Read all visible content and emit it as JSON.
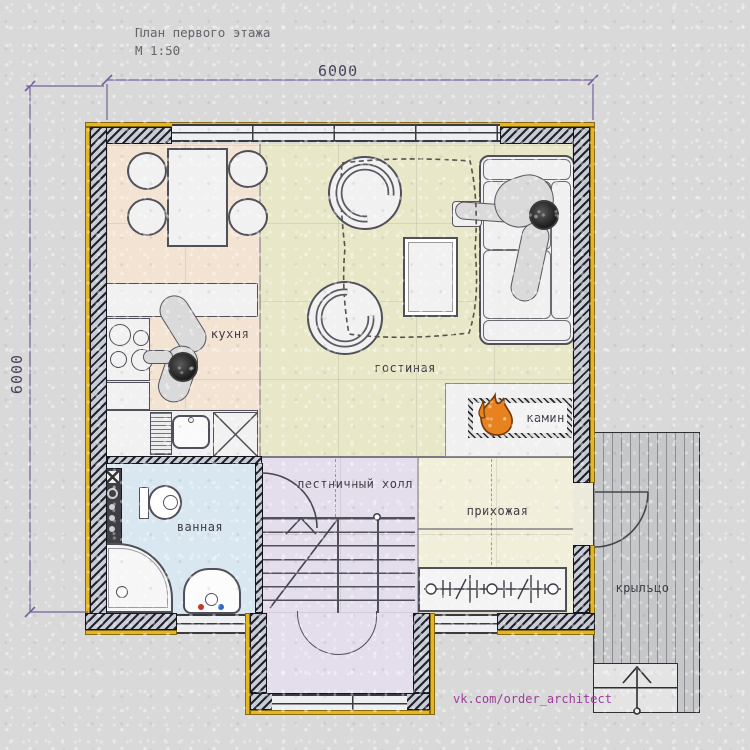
{
  "title": {
    "name": "План первого этажа",
    "scale": "М 1:50"
  },
  "dimensions": {
    "width_mm": "6000",
    "height_mm": "6000"
  },
  "rooms": {
    "kitchen": "кухня",
    "living_room": "гостиная",
    "fireplace": "камин",
    "stair_hall": "лестничный холл",
    "hallway": "прихожая",
    "bathroom": "ванная",
    "porch": "крыльцо"
  },
  "watermark": "vk.com/order_architect",
  "icons": {
    "fireplace_flame": "flame-icon",
    "stairs_direction": "up-arrow-icon",
    "porch_entry": "up-arrow-icon"
  },
  "colors": {
    "background": "#d9d9d9",
    "wall_hatch_dark": "#23232e",
    "wall_insulation": "#e3b722",
    "kitchen_floor": "#f3e3d2",
    "living_floor": "#e8e8c9",
    "stair_floor": "#e4ddec",
    "hallway_floor": "#f1eeda",
    "bathroom_floor": "#d9e7f1",
    "porch_floor": "#c6c7c9",
    "flame": "#e8821e",
    "dimension": "#75619a",
    "watermark": "#9b3f9b",
    "label_text": "#3c3c44"
  }
}
